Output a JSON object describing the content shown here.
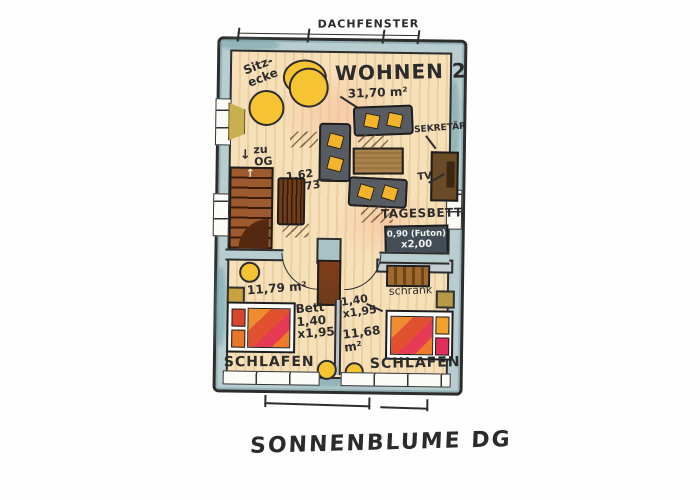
{
  "title": "SONNENBLUME DG",
  "colors": {
    "wall_fill": "#b7cdd0",
    "floor_wood": "#f6e0ba",
    "accent_yellow": "#f3b32b",
    "bed_red": "#e2512f",
    "stair_brown": "#9c5a2e",
    "daybed_slate": "#434d55",
    "outline": "#2d2d2d"
  },
  "plan": {
    "roof_window_label": "DACHFENSTER",
    "living": {
      "name": "WOHNEN 2",
      "area": "31,70 m²",
      "sitzecke_line1": "Sitz-",
      "sitzecke_line2": "ecke",
      "stairs_arrow": "↓",
      "stairs_line1": "zu",
      "stairs_line2": "OG",
      "stairs_run_arrow": "↑",
      "table_dim_line1": "1,62",
      "table_dim_line2": "x 0,73",
      "desk_label": "SEKRETÄR",
      "tv_label": "TV"
    },
    "daybed": {
      "label": "TAGESBETT",
      "dim_line1": "0,90 (Futon)",
      "dim_line2": "x2,00"
    },
    "bedroom_left": {
      "area": "11,79 m²",
      "bed_label": "Bett",
      "bed_dim_line1": "1,40",
      "bed_dim_line2": "x1,95",
      "name": "SCHLAFEN"
    },
    "bedroom_right": {
      "closet_label": "schrank",
      "bed_dim_line1": "1,40",
      "bed_dim_line2": "x1,95",
      "area_line1": "11,68",
      "area_line2": "m²",
      "name": "SCHLAFEN"
    }
  }
}
